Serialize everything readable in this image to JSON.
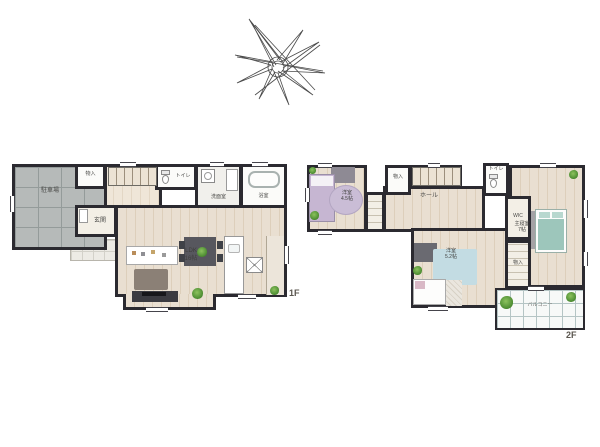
{
  "colors": {
    "wall": "#2b2a30",
    "wood": "#e9dfd1",
    "garage": "#b6bab9",
    "rug_purple": "#cabdd6",
    "bed_purple": "#c6b6d2",
    "bed_teal": "#9dc6bb",
    "rug_blue": "#c3dce3",
    "plant": "#4f8f34",
    "balcony_grid": "#b5c5c5"
  },
  "compass": {
    "name": "hand-drawn-north-star"
  },
  "floor1": {
    "marker": "1F",
    "garage": "駐車場",
    "storage": "物入",
    "toilet": "トイレ",
    "washroom": "洗面室",
    "bath": "浴室",
    "entrance": "玄関",
    "ldk": [
      "LDK",
      "16帖"
    ]
  },
  "floor2": {
    "marker": "2F",
    "bedroom_west": [
      "洋室",
      "4.5帖"
    ],
    "storage": "物入",
    "hall": "ホール",
    "toilet": "トイレ",
    "master": [
      "主寝室",
      "7帖"
    ],
    "wic": "WIC",
    "closet": "物入",
    "bedroom_south": [
      "洋室",
      "5.2帖"
    ],
    "balcony": "バルコニー"
  }
}
